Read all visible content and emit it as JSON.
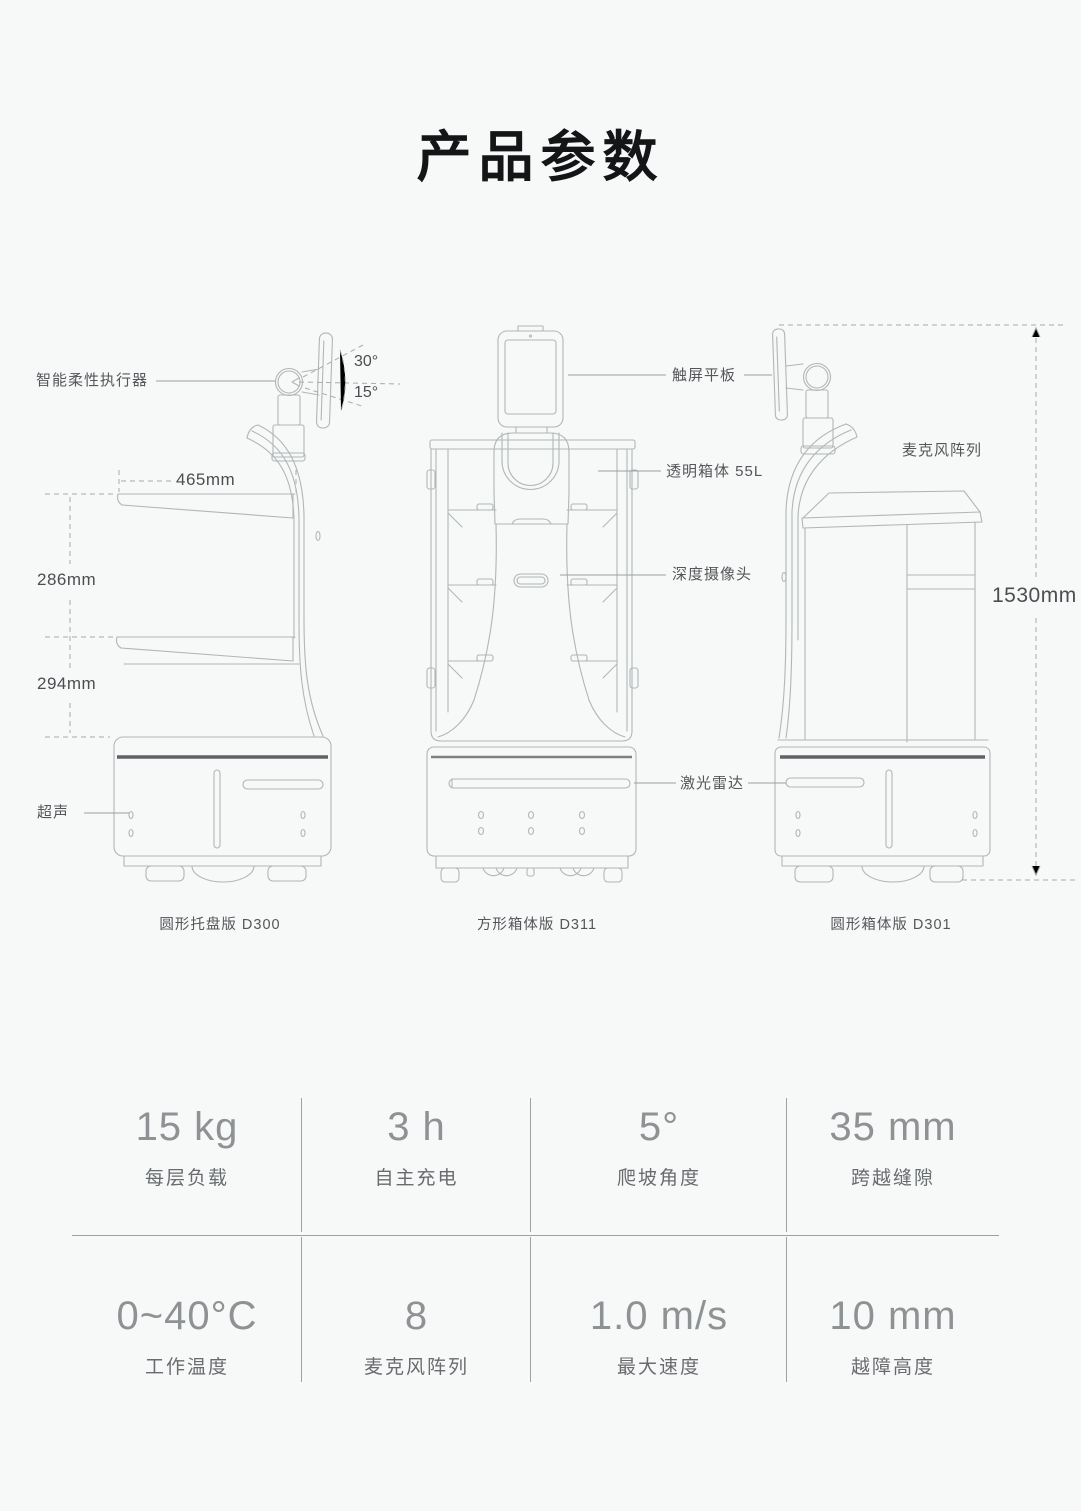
{
  "page": {
    "title": "产品参数"
  },
  "diagram": {
    "callouts": {
      "actuator": "智能柔性执行器",
      "touch_tablet": "触屏平板",
      "transparent_box": "透明箱体 55L",
      "mic_array": "麦克风阵列",
      "depth_camera": "深度摄像头",
      "lidar": "激光雷达",
      "ultrasonic": "超声"
    },
    "dimensions": {
      "tray_width": "465mm",
      "gap_upper": "286mm",
      "gap_lower": "294mm",
      "total_height": "1530mm",
      "angle_up": "30°",
      "angle_down": "15°"
    },
    "captions": {
      "left": "圆形托盘版 D300",
      "middle": "方形箱体版 D311",
      "right": "圆形箱体版 D301"
    }
  },
  "specs": {
    "rows": [
      [
        {
          "value": "15 kg",
          "label": "每层负载"
        },
        {
          "value": "3 h",
          "label": "自主充电"
        },
        {
          "value": "5°",
          "label": "爬坡角度"
        },
        {
          "value": "35 mm",
          "label": "跨越缝隙"
        }
      ],
      [
        {
          "value": "0~40°C",
          "label": "工作温度"
        },
        {
          "value": "8",
          "label": "麦克风阵列"
        },
        {
          "value": "1.0 m/s",
          "label": "最大速度"
        },
        {
          "value": "10 mm",
          "label": "越障高度"
        }
      ]
    ]
  },
  "colors": {
    "c-bg": "#f7f8f8",
    "c-line": "#b2b6b6",
    "c-dark": "#5f6365",
    "c-leader": "#9aa0a0",
    "c-dash": "#a8acac",
    "c-text": "#54575a",
    "c-title": "#141517",
    "c-value": "#8f9294",
    "c-label": "#696c6f",
    "c-divider": "#a0a0a0"
  }
}
